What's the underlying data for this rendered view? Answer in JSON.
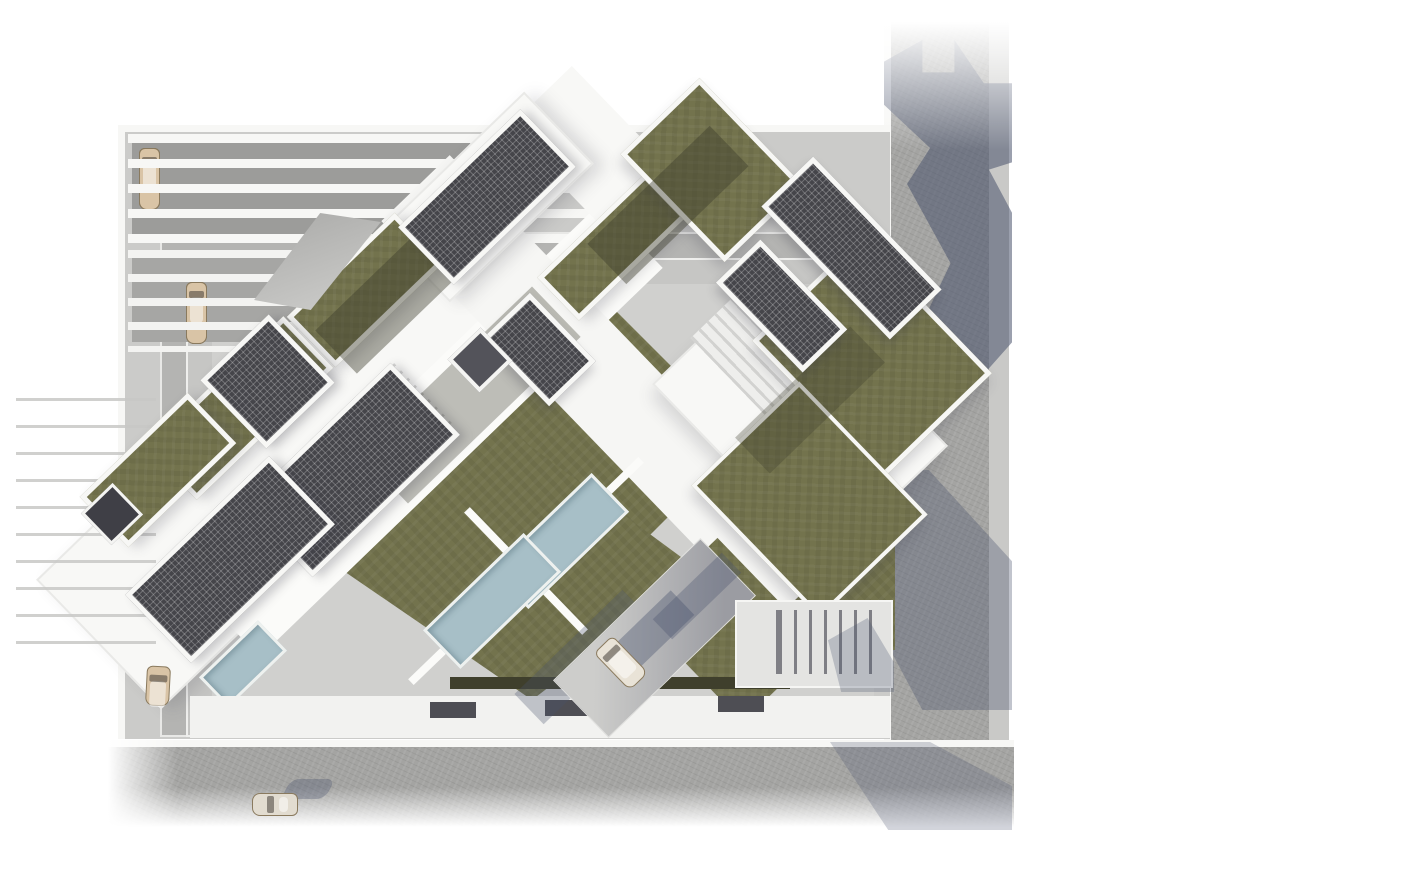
{
  "scene": {
    "title": "Aerial top-down 3D architectural rendering of a housing complex with green roofs, rooftop solar panels, swimming pools, a pergola-covered parking court and perimeter streets",
    "view": "top-down axonometric render, buildings rotated ~45° to the street grid",
    "features": [
      "green-roofs",
      "solar-panel-arrays",
      "swimming-pools",
      "pergola-parking-rows",
      "white-roof-slabs",
      "perimeter-road-right",
      "perimeter-road-bottom",
      "cast-building-shadows",
      "access-ramp-with-car",
      "courtyard-stairs"
    ],
    "counts": {
      "parking_row_main_cars": 8,
      "parking_row_secondary_cars": 3,
      "street_cars": 1,
      "courtyard_cars": 2,
      "pools": 3
    },
    "palette": {
      "background": "#ffffff",
      "road": "#a4a4a2",
      "road_sidewalk": "#c9c9c7",
      "curb_white": "#f7f7f5",
      "site_paving": "#cbcbc9",
      "site_paving_dark": "#b4b4b2",
      "roof_white": "#f8f8f6",
      "green_roof": "#73734d",
      "green_roof_shade": "#3c3c2a",
      "solar_panel": "#45454a",
      "pool_water": "#a7bfc7",
      "car_beige": "#d9c4a6",
      "car_gray": "#7e7e7c",
      "cast_shadow": "rgba(73,82,108,0.55)",
      "hedge_dark": "#3f3f2c",
      "pergola_floor": "#9c9c9a"
    }
  }
}
